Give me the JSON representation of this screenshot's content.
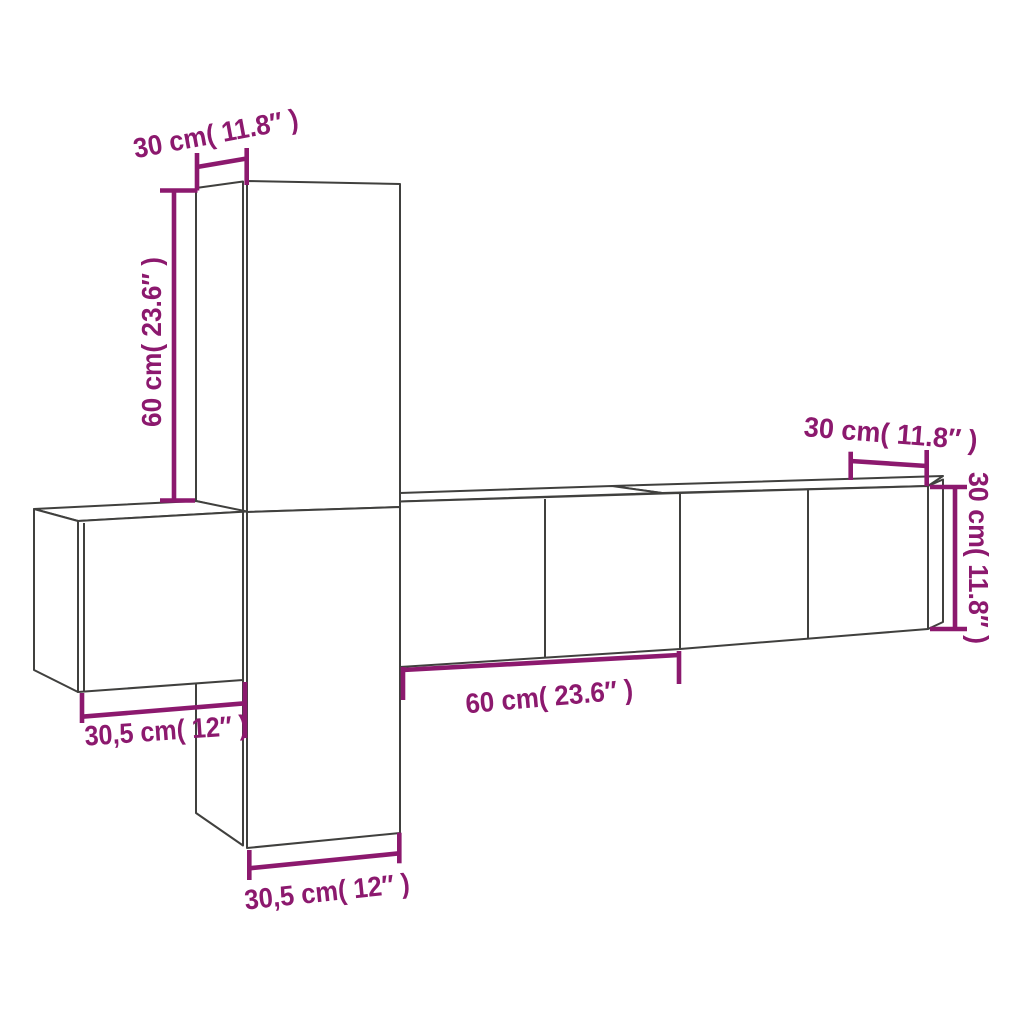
{
  "diagram": {
    "colors": {
      "background": "#ffffff",
      "outline": "#40403e",
      "dimension_accent": "#8C196E"
    },
    "labels": {
      "top_cabinet_width": "30 cm( 11.8″ )",
      "top_cabinet_height": "60 cm( 23.6″ )",
      "left_cabinet_width": "30,5 cm( 12″ )",
      "middle_cabinet_width": "60 cm( 23.6″ )",
      "bottom_cabinet_width": "30,5 cm( 12″ )",
      "right_cabinet_width": "30 cm( 11.8″ )",
      "right_cabinet_height": "30 cm( 11.8″ )"
    }
  }
}
